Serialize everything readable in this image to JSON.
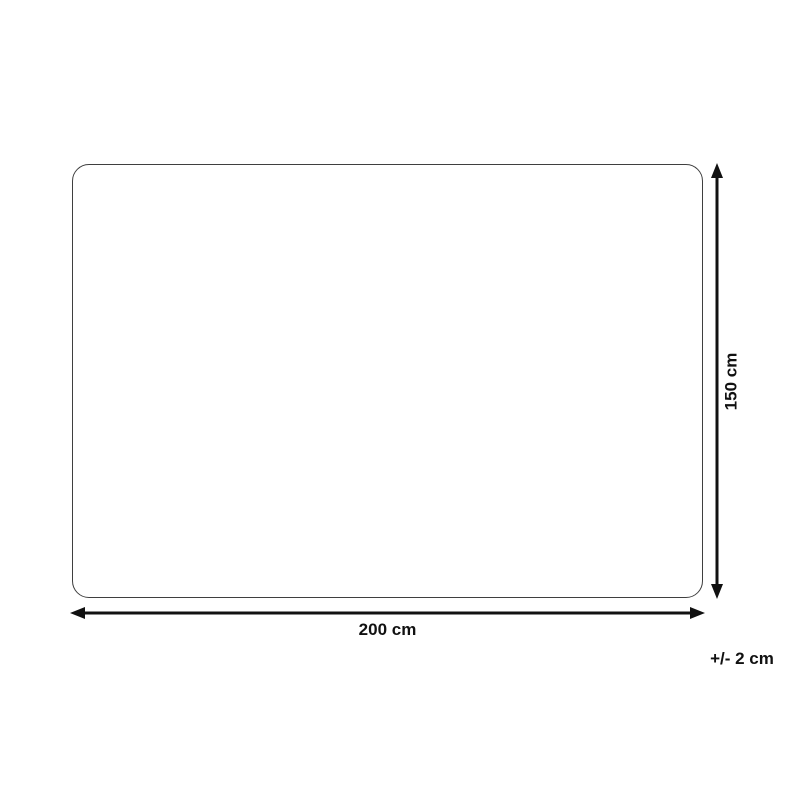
{
  "colors": {
    "background": "#ffffff",
    "outline": "#3f3f3f",
    "line": "#111111",
    "text": "#111111"
  },
  "diagram": {
    "width_label": "200 cm",
    "height_label": "150 cm",
    "tolerance_label": "+/- 2 cm"
  }
}
